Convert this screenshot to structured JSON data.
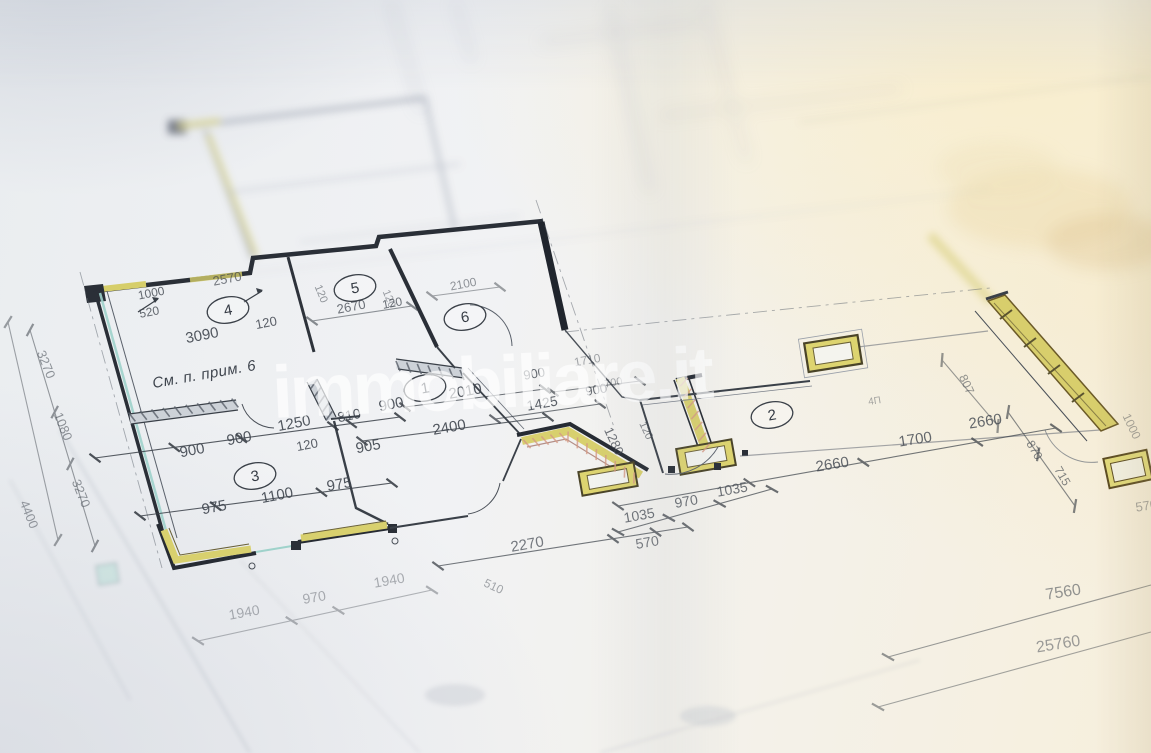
{
  "meta": {
    "description": "Photograph of an architectural floor-plan blueprint (Russian annotations), shot at an angle with shallow depth of field",
    "language": "ru"
  },
  "watermark": {
    "text": "immobiliare.it"
  },
  "note": {
    "text": "См. п. прим. 6",
    "x": 205,
    "y": 379,
    "r": -10
  },
  "colors": {
    "paper": "#f1f2f4",
    "line": "#3a4048",
    "wall": "#262b33",
    "window_yellow": "#d8d06e",
    "window_teal": "#9fd2cb",
    "hatch_pink": "#d59a85",
    "warm_light": "#f7ecd2",
    "watermark_white": "rgba(255,255,255,0.58)"
  },
  "rooms": [
    {
      "number": "1",
      "x": 425,
      "y": 388
    },
    {
      "number": "2",
      "x": 772,
      "y": 415
    },
    {
      "number": "3",
      "x": 255,
      "y": 476
    },
    {
      "number": "4",
      "x": 228,
      "y": 310
    },
    {
      "number": "5",
      "x": 355,
      "y": 288
    },
    {
      "number": "6",
      "x": 465,
      "y": 317
    }
  ],
  "dimension_labels": [
    {
      "t": "2570",
      "x": 228,
      "y": 283,
      "r": -11,
      "s": 13,
      "o": 0.7
    },
    {
      "t": "1000",
      "x": 152,
      "y": 297,
      "r": -11,
      "s": 12,
      "o": 0.8
    },
    {
      "t": "520",
      "x": 150,
      "y": 316,
      "r": -11,
      "s": 12,
      "o": 0.8
    },
    {
      "t": "3090",
      "x": 203,
      "y": 340,
      "r": -11,
      "s": 15,
      "o": 0.9
    },
    {
      "t": "120",
      "x": 267,
      "y": 327,
      "r": -11,
      "s": 13,
      "o": 0.85
    },
    {
      "t": "2670",
      "x": 352,
      "y": 311,
      "r": -11,
      "s": 13,
      "o": 0.75
    },
    {
      "t": "120",
      "x": 393,
      "y": 307,
      "r": -11,
      "s": 12,
      "o": 0.75
    },
    {
      "t": "2100",
      "x": 464,
      "y": 288,
      "r": -11,
      "s": 12,
      "o": 0.55
    },
    {
      "t": "120",
      "x": 318,
      "y": 295,
      "r": 68,
      "s": 11,
      "o": 0.55
    },
    {
      "t": "120",
      "x": 386,
      "y": 300,
      "r": 68,
      "s": 11,
      "o": 0.5
    },
    {
      "t": "900",
      "x": 193,
      "y": 455,
      "r": -11,
      "s": 15,
      "o": 0.9
    },
    {
      "t": "900",
      "x": 240,
      "y": 443,
      "r": -11,
      "s": 15,
      "o": 0.9
    },
    {
      "t": "1250",
      "x": 295,
      "y": 428,
      "r": -11,
      "s": 15,
      "o": 0.9
    },
    {
      "t": "120",
      "x": 308,
      "y": 449,
      "r": -11,
      "s": 13,
      "o": 0.85
    },
    {
      "t": "905",
      "x": 369,
      "y": 451,
      "r": -11,
      "s": 15,
      "o": 0.9
    },
    {
      "t": "810",
      "x": 350,
      "y": 420,
      "r": -11,
      "s": 14,
      "o": 0.9
    },
    {
      "t": "900",
      "x": 392,
      "y": 409,
      "r": -11,
      "s": 15,
      "o": 0.9
    },
    {
      "t": "2400",
      "x": 450,
      "y": 432,
      "r": -10,
      "s": 15,
      "o": 0.9
    },
    {
      "t": "2010",
      "x": 466,
      "y": 396,
      "r": -10,
      "s": 15,
      "o": 0.9
    },
    {
      "t": "975",
      "x": 215,
      "y": 512,
      "r": -11,
      "s": 15,
      "o": 0.9
    },
    {
      "t": "1100",
      "x": 278,
      "y": 500,
      "r": -11,
      "s": 15,
      "o": 0.9
    },
    {
      "t": "975",
      "x": 340,
      "y": 489,
      "r": -10,
      "s": 15,
      "o": 0.9
    },
    {
      "t": "900",
      "x": 535,
      "y": 378,
      "r": -10,
      "s": 13,
      "o": 0.8
    },
    {
      "t": "1425",
      "x": 543,
      "y": 408,
      "r": -10,
      "s": 14,
      "o": 0.85
    },
    {
      "t": "900",
      "x": 597,
      "y": 394,
      "r": -10,
      "s": 13,
      "o": 0.75
    },
    {
      "t": "1710",
      "x": 588,
      "y": 364,
      "r": -10,
      "s": 12,
      "o": 0.45
    },
    {
      "t": "700",
      "x": 614,
      "y": 386,
      "r": -10,
      "s": 11,
      "o": 0.45
    },
    {
      "t": "1280",
      "x": 610,
      "y": 443,
      "r": 65,
      "s": 13,
      "o": 0.75
    },
    {
      "t": "120",
      "x": 643,
      "y": 432,
      "r": 65,
      "s": 11,
      "o": 0.65
    },
    {
      "t": "1035",
      "x": 640,
      "y": 520,
      "r": -10,
      "s": 14,
      "o": 0.75
    },
    {
      "t": "970",
      "x": 687,
      "y": 506,
      "r": -10,
      "s": 14,
      "o": 0.75
    },
    {
      "t": "1035",
      "x": 733,
      "y": 494,
      "r": -10,
      "s": 14,
      "o": 0.75
    },
    {
      "t": "2270",
      "x": 528,
      "y": 549,
      "r": -10,
      "s": 15,
      "o": 0.7
    },
    {
      "t": "570",
      "x": 648,
      "y": 547,
      "r": -10,
      "s": 14,
      "o": 0.7
    },
    {
      "t": "510",
      "x": 492,
      "y": 590,
      "r": 25,
      "s": 12,
      "o": 0.45
    },
    {
      "t": "1940",
      "x": 245,
      "y": 617,
      "r": -10,
      "s": 14,
      "o": 0.4
    },
    {
      "t": "970",
      "x": 315,
      "y": 602,
      "r": -10,
      "s": 14,
      "o": 0.4
    },
    {
      "t": "1940",
      "x": 390,
      "y": 585,
      "r": -10,
      "s": 14,
      "o": 0.4
    },
    {
      "t": "2660",
      "x": 833,
      "y": 469,
      "r": -9,
      "s": 15,
      "o": 0.8
    },
    {
      "t": "1700",
      "x": 916,
      "y": 444,
      "r": -9,
      "s": 15,
      "o": 0.8
    },
    {
      "t": "2660",
      "x": 986,
      "y": 426,
      "r": -9,
      "s": 15,
      "o": 0.8
    },
    {
      "t": "807",
      "x": 963,
      "y": 386,
      "r": 65,
      "s": 12,
      "o": 0.55
    },
    {
      "t": "4П",
      "x": 875,
      "y": 404,
      "r": -9,
      "s": 10,
      "o": 0.45
    },
    {
      "t": "870",
      "x": 1031,
      "y": 452,
      "r": 60,
      "s": 12,
      "o": 0.65
    },
    {
      "t": "715",
      "x": 1059,
      "y": 478,
      "r": 60,
      "s": 12,
      "o": 0.65
    },
    {
      "t": "1000",
      "x": 1128,
      "y": 428,
      "r": 65,
      "s": 12,
      "o": 0.45
    },
    {
      "t": "570",
      "x": 1147,
      "y": 510,
      "r": -9,
      "s": 13,
      "o": 0.45
    },
    {
      "t": "7560",
      "x": 1064,
      "y": 597,
      "r": -9,
      "s": 16,
      "o": 0.55
    },
    {
      "t": "25760",
      "x": 1059,
      "y": 649,
      "r": -9,
      "s": 16,
      "o": 0.5
    },
    {
      "t": "3270",
      "x": 42,
      "y": 366,
      "r": 68,
      "s": 13,
      "o": 0.55
    },
    {
      "t": "1080",
      "x": 59,
      "y": 428,
      "r": 68,
      "s": 13,
      "o": 0.55
    },
    {
      "t": "3270",
      "x": 77,
      "y": 495,
      "r": 68,
      "s": 13,
      "o": 0.55
    },
    {
      "t": "4400",
      "x": 25,
      "y": 516,
      "r": 68,
      "s": 13,
      "o": 0.5
    }
  ]
}
